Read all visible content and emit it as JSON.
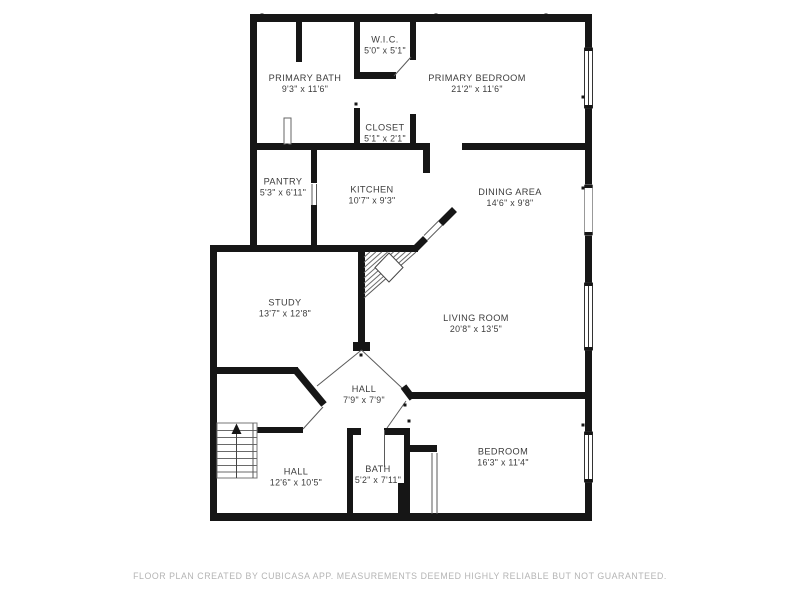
{
  "meta": {
    "background_color": "#ffffff",
    "wall_color": "#161616",
    "label_color": "#3c3c3c",
    "footer_color": "#b4b4b4"
  },
  "rooms": [
    {
      "id": "wic",
      "name": "W.I.C.",
      "dims": "5'0\" x 5'1\""
    },
    {
      "id": "primary-bath",
      "name": "PRIMARY BATH",
      "dims": "9'3\" x 11'6\""
    },
    {
      "id": "primary-bedroom",
      "name": "PRIMARY BEDROOM",
      "dims": "21'2\" x 11'6\""
    },
    {
      "id": "closet",
      "name": "CLOSET",
      "dims": "5'1\" x 2'1\""
    },
    {
      "id": "pantry",
      "name": "PANTRY",
      "dims": "5'3\" x 6'11\""
    },
    {
      "id": "kitchen",
      "name": "KITCHEN",
      "dims": "10'7\" x 9'3\""
    },
    {
      "id": "dining-area",
      "name": "DINING AREA",
      "dims": "14'6\" x 9'8\""
    },
    {
      "id": "study",
      "name": "STUDY",
      "dims": "13'7\" x 12'8\""
    },
    {
      "id": "living-room",
      "name": "LIVING ROOM",
      "dims": "20'8\" x 13'5\""
    },
    {
      "id": "hall-center",
      "name": "HALL",
      "dims": "7'9\" x 7'9\""
    },
    {
      "id": "hall-lower",
      "name": "HALL",
      "dims": "12'6\" x 10'5\""
    },
    {
      "id": "bath",
      "name": "BATH",
      "dims": "5'2\" x 7'11\""
    },
    {
      "id": "bedroom",
      "name": "BEDROOM",
      "dims": "16'3\" x 11'4\""
    }
  ],
  "footer": {
    "text": "FLOOR PLAN CREATED BY CUBICASA APP. MEASUREMENTS DEEMED HIGHLY RELIABLE BUT NOT GUARANTEED."
  }
}
